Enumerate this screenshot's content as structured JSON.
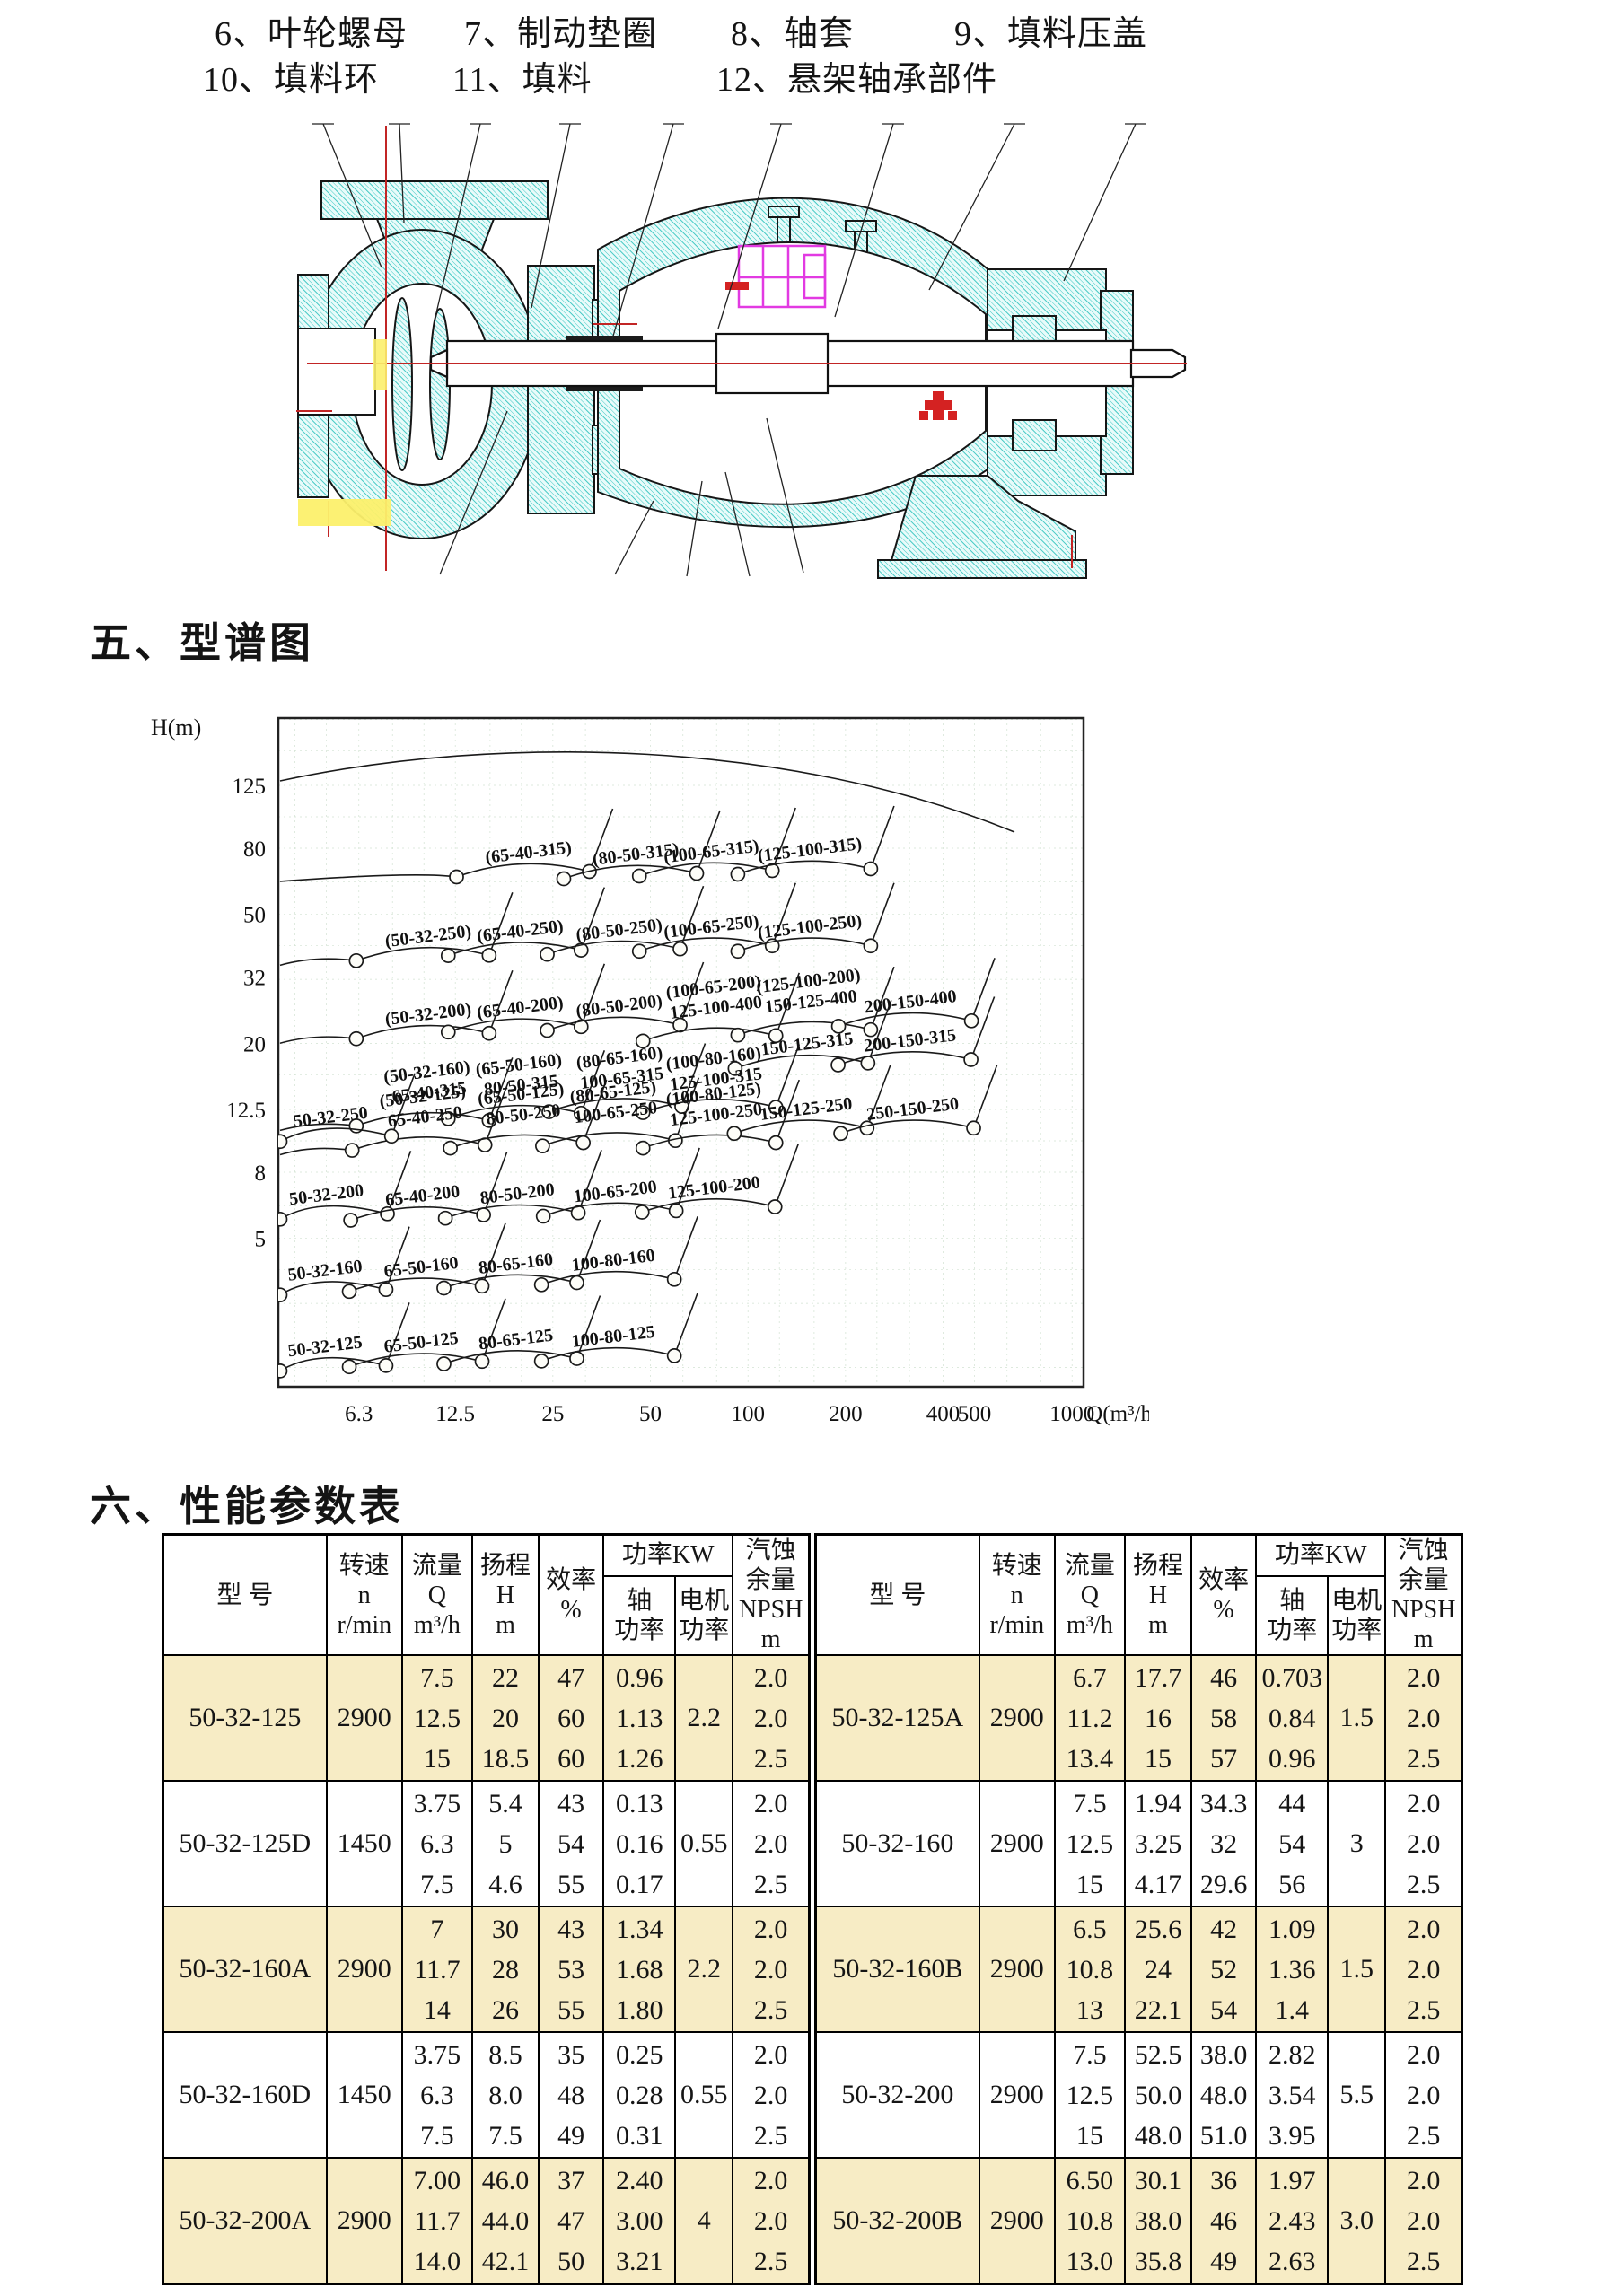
{
  "parts_list": {
    "line1": [
      "6、叶轮螺母",
      "7、制动垫圈",
      "8、轴套",
      "9、填料压盖"
    ],
    "line2": [
      "10、填料环",
      "11、填料",
      "12、悬架轴承部件"
    ]
  },
  "sections": {
    "spectrum_title": "五、型谱图",
    "performance_title": "六、性能参数表"
  },
  "chart_data": {
    "type": "line",
    "title": "泵型谱图",
    "xlabel": "Q(m³/h)",
    "ylabel": "H(m)",
    "x_axis": {
      "scale": "log",
      "ticks": [
        "6.3",
        "12.5",
        "25",
        "50",
        "100",
        "200",
        "400",
        "500",
        "1000"
      ],
      "unit": "Q(m³/h)"
    },
    "y_axis": {
      "scale": "log",
      "ticks": [
        "125",
        "80",
        "50",
        "32",
        "20",
        "12.5",
        "8",
        "5"
      ],
      "label": "H(m)"
    },
    "grid": "on",
    "cells": [
      {
        "label": "(65-40-315)",
        "q": 21,
        "h": 78
      },
      {
        "label": "(80-50-315)",
        "q": 45,
        "h": 77
      },
      {
        "label": "(100-65-315)",
        "q": 77,
        "h": 78.5
      },
      {
        "label": "(125-100-315)",
        "q": 155,
        "h": 79.5
      },
      {
        "label": "(50-32-250)",
        "q": 10.3,
        "h": 43
      },
      {
        "label": "(65-40-250)",
        "q": 19.8,
        "h": 44.6
      },
      {
        "label": "(80-50-250)",
        "q": 40,
        "h": 45
      },
      {
        "label": "(100-65-250)",
        "q": 77,
        "h": 46
      },
      {
        "label": "(125-100-250)",
        "q": 155,
        "h": 46
      },
      {
        "label": "(50-32-200)",
        "q": 10.3,
        "h": 24.7
      },
      {
        "label": "(65-40-200)",
        "q": 19.8,
        "h": 25.9
      },
      {
        "label": "(80-50-200)",
        "q": 40,
        "h": 26.2
      },
      {
        "label": "(100-65-200)\n125-100-400",
        "q": 79,
        "h": 27.6
      },
      {
        "label": "(125-100-200)\n150-125-400",
        "q": 155,
        "h": 28.8
      },
      {
        "label": "200-150-400",
        "q": 317,
        "h": 27
      },
      {
        "label": "(50-32-160)\n65-40-315",
        "q": 10.3,
        "h": 15.1
      },
      {
        "label": "(65-50-160)\n80-50-315",
        "q": 19.8,
        "h": 15.9
      },
      {
        "label": "(80-65-160)\n100-65-315",
        "q": 40.5,
        "h": 16.7
      },
      {
        "label": "(100-80-160)\n125-100-315",
        "q": 79,
        "h": 16.6
      },
      {
        "label": "150-125-315",
        "q": 152,
        "h": 20
      },
      {
        "label": "200-150-315",
        "q": 316,
        "h": 20.5
      },
      {
        "label": "(50-32-125)\n65-40-250",
        "q": 10,
        "h": 12.7
      },
      {
        "label": "(65-50-125)\n80-50-250",
        "q": 20.1,
        "h": 12.9
      },
      {
        "label": "(80-65-125)\n100-65-250",
        "q": 38.7,
        "h": 13.1
      },
      {
        "label": "(100-80-125)\n125-100-250",
        "q": 79,
        "h": 12.9
      },
      {
        "label": "150-125-250",
        "q": 151,
        "h": 12.6
      },
      {
        "label": "250-150-250",
        "q": 322,
        "h": 12.6
      },
      {
        "label": "50-32-250",
        "q": 5.15,
        "h": 11.9
      },
      {
        "label": "50-32-200",
        "q": 5.0,
        "h": 6.85
      },
      {
        "label": "65-40-200",
        "q": 9.9,
        "h": 6.8
      },
      {
        "label": "80-50-200",
        "q": 19.4,
        "h": 6.9
      },
      {
        "label": "100-65-200",
        "q": 38.9,
        "h": 7.0
      },
      {
        "label": "125-100-200",
        "q": 78.5,
        "h": 7.2
      },
      {
        "label": "50-32-160",
        "q": 4.95,
        "h": 4.0
      },
      {
        "label": "65-50-160",
        "q": 9.8,
        "h": 4.1
      },
      {
        "label": "80-65-160",
        "q": 19.2,
        "h": 4.2
      },
      {
        "label": "100-80-160",
        "q": 38.4,
        "h": 4.3
      },
      {
        "label": "50-32-125",
        "q": 4.95,
        "h": 2.33
      },
      {
        "label": "65-50-125",
        "q": 9.8,
        "h": 2.4
      },
      {
        "label": "80-65-125",
        "q": 19.2,
        "h": 2.45
      },
      {
        "label": "100-80-125",
        "q": 38.4,
        "h": 2.5
      }
    ]
  },
  "table": {
    "headers": {
      "model": "型   号",
      "speed": "转速\nn\nr/min",
      "flow": "流量\nQ\nm³/h",
      "head": "扬程\nH\nm",
      "efficiency": "效率\n%",
      "power_kw": "功率KW",
      "shaft_power": "轴\n功率",
      "motor_power": "电机\n功率",
      "npsh": "汽蚀\n余量\nNPSH\nm"
    },
    "left_rows": [
      {
        "model": "50-32-125",
        "speed": "2900",
        "q": [
          "7.5",
          "12.5",
          "15"
        ],
        "h": [
          "22",
          "20",
          "18.5"
        ],
        "eff": [
          "47",
          "60",
          "60"
        ],
        "shaft": [
          "0.96",
          "1.13",
          "1.26"
        ],
        "motor": "2.2",
        "npsh": [
          "2.0",
          "2.0",
          "2.5"
        ],
        "highlight": true
      },
      {
        "model": "50-32-125D",
        "speed": "1450",
        "q": [
          "3.75",
          "6.3",
          "7.5"
        ],
        "h": [
          "5.4",
          "5",
          "4.6"
        ],
        "eff": [
          "43",
          "54",
          "55"
        ],
        "shaft": [
          "0.13",
          "0.16",
          "0.17"
        ],
        "motor": "0.55",
        "npsh": [
          "2.0",
          "2.0",
          "2.5"
        ],
        "highlight": false
      },
      {
        "model": "50-32-160A",
        "speed": "2900",
        "q": [
          "7",
          "11.7",
          "14"
        ],
        "h": [
          "30",
          "28",
          "26"
        ],
        "eff": [
          "43",
          "53",
          "55"
        ],
        "shaft": [
          "1.34",
          "1.68",
          "1.80"
        ],
        "motor": "2.2",
        "npsh": [
          "2.0",
          "2.0",
          "2.5"
        ],
        "highlight": true
      },
      {
        "model": "50-32-160D",
        "speed": "1450",
        "q": [
          "3.75",
          "6.3",
          "7.5"
        ],
        "h": [
          "8.5",
          "8.0",
          "7.5"
        ],
        "eff": [
          "35",
          "48",
          "49"
        ],
        "shaft": [
          "0.25",
          "0.28",
          "0.31"
        ],
        "motor": "0.55",
        "npsh": [
          "2.0",
          "2.0",
          "2.5"
        ],
        "highlight": false
      },
      {
        "model": "50-32-200A",
        "speed": "2900",
        "q": [
          "7.00",
          "11.7",
          "14.0"
        ],
        "h": [
          "46.0",
          "44.0",
          "42.1"
        ],
        "eff": [
          "37",
          "47",
          "50"
        ],
        "shaft": [
          "2.40",
          "3.00",
          "3.21"
        ],
        "motor": "4",
        "npsh": [
          "2.0",
          "2.0",
          "2.5"
        ],
        "highlight": true
      }
    ],
    "right_rows": [
      {
        "model": "50-32-125A",
        "speed": "2900",
        "q": [
          "6.7",
          "11.2",
          "13.4"
        ],
        "h": [
          "17.7",
          "16",
          "15"
        ],
        "eff": [
          "46",
          "58",
          "57"
        ],
        "shaft": [
          "0.703",
          "0.84",
          "0.96"
        ],
        "motor": "1.5",
        "npsh": [
          "2.0",
          "2.0",
          "2.5"
        ],
        "highlight": true
      },
      {
        "model": "50-32-160",
        "speed": "2900",
        "q": [
          "7.5",
          "12.5",
          "15"
        ],
        "h": [
          "1.94",
          "3.25",
          "4.17"
        ],
        "eff": [
          "34.3",
          "32",
          "29.6"
        ],
        "shaft": [
          "44",
          "54",
          "56"
        ],
        "motor": "3",
        "npsh": [
          "2.0",
          "2.0",
          "2.5"
        ],
        "highlight": false
      },
      {
        "model": "50-32-160B",
        "speed": "2900",
        "q": [
          "6.5",
          "10.8",
          "13"
        ],
        "h": [
          "25.6",
          "24",
          "22.1"
        ],
        "eff": [
          "42",
          "52",
          "54"
        ],
        "shaft": [
          "1.09",
          "1.36",
          "1.4"
        ],
        "motor": "1.5",
        "npsh": [
          "2.0",
          "2.0",
          "2.5"
        ],
        "highlight": true
      },
      {
        "model": "50-32-200",
        "speed": "2900",
        "q": [
          "7.5",
          "12.5",
          "15"
        ],
        "h": [
          "52.5",
          "50.0",
          "48.0"
        ],
        "eff": [
          "38.0",
          "48.0",
          "51.0"
        ],
        "shaft": [
          "2.82",
          "3.54",
          "3.95"
        ],
        "motor": "5.5",
        "npsh": [
          "2.0",
          "2.0",
          "2.5"
        ],
        "highlight": false
      },
      {
        "model": "50-32-200B",
        "speed": "2900",
        "q": [
          "6.50",
          "10.8",
          "13.0"
        ],
        "h": [
          "30.1",
          "38.0",
          "35.8"
        ],
        "eff": [
          "36",
          "46",
          "49"
        ],
        "shaft": [
          "1.97",
          "2.43",
          "2.63"
        ],
        "motor": "3.0",
        "npsh": [
          "2.0",
          "2.0",
          "2.5"
        ],
        "highlight": true
      }
    ]
  },
  "colors": {
    "row_highlight": "#f7ecc5",
    "diagram_teal": "#43c9c4",
    "centerline_red": "#c22525",
    "seal_magenta": "#e23ae2",
    "highlight_yellow": "#fcf06c"
  }
}
